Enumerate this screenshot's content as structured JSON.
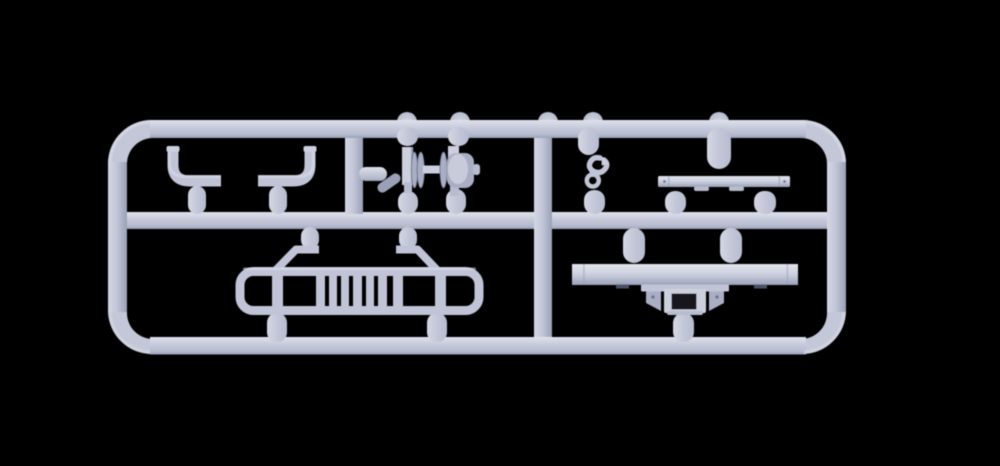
{
  "scene": {
    "type": "3d-render-photo",
    "subject": "Light gray injection-molded plastic model kit sprue (runner frame) holding vehicle accessory parts, on a black background",
    "background": "#000000",
    "canvas": {
      "width": 1000,
      "height": 466
    }
  },
  "colors": {
    "bg": "#000000",
    "base": "#c3c7d8",
    "hl": "#dfe2ec",
    "light": "#d4d7e3",
    "part": "#c0c4d6",
    "plate": "#ccd0de",
    "mid": "#b7bccf",
    "shade": "#99a0b7",
    "disc": "#a9aec4",
    "dark": "#6e7590",
    "tab": "#4c5166",
    "hole": "#14161f"
  },
  "sprue": {
    "frame": "rounded rectangle runner with one horizontal mid-rail and two vertical dividers",
    "parts": [
      {
        "name": "mudguard-bracket-left",
        "cell": "top-left"
      },
      {
        "name": "mudguard-bracket-right",
        "cell": "top-left"
      },
      {
        "name": "wheel-axle-assembly",
        "cell": "top-middle"
      },
      {
        "name": "tow-hook-s-shape",
        "cell": "top-right"
      },
      {
        "name": "mounting-strip",
        "cell": "top-right"
      },
      {
        "name": "running-board-frame",
        "cell": "bottom-left"
      },
      {
        "name": "bumper-bar",
        "cell": "bottom-right"
      },
      {
        "name": "tow-coupling-bracket",
        "cell": "bottom-right"
      }
    ]
  }
}
